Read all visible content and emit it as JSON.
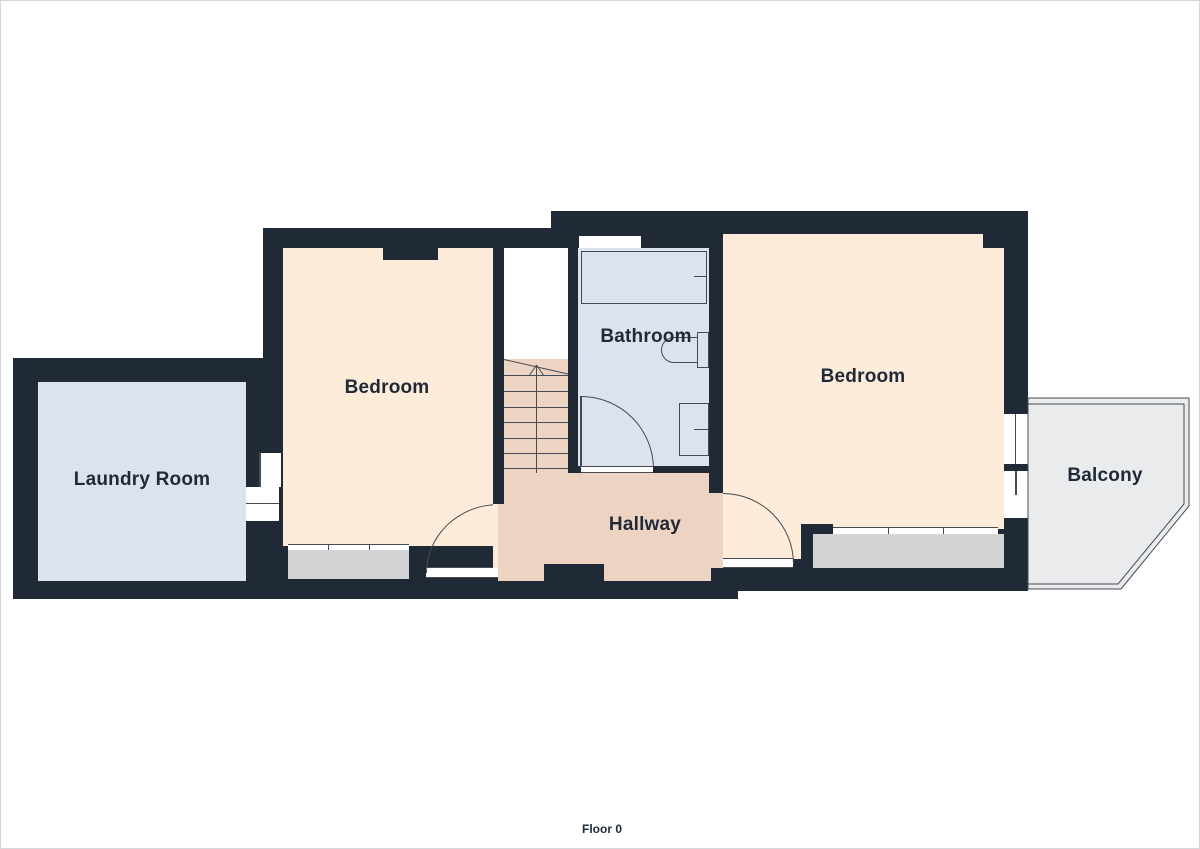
{
  "footer": {
    "label": "Floor 0"
  },
  "rooms": {
    "laundry": {
      "label": "Laundry Room"
    },
    "bedroom_left": {
      "label": "Bedroom"
    },
    "bathroom": {
      "label": "Bathroom"
    },
    "hallway": {
      "label": "Hallway"
    },
    "bedroom_right": {
      "label": "Bedroom"
    },
    "balcony": {
      "label": "Balcony"
    }
  },
  "fixtures": [
    "bathtub",
    "toilet",
    "sink",
    "stairs-up-arrow",
    "doors",
    "windows"
  ],
  "colors": {
    "wall": "#202a37",
    "bedroom_floor": "#fcecd9",
    "hallway_floor": "#edd3c2",
    "wet_room_floor": "#dde3ee",
    "balcony_floor": "#e9ebec",
    "window_bay": "#d2d3d5",
    "line": "#454b54",
    "text": "#1f2937"
  }
}
